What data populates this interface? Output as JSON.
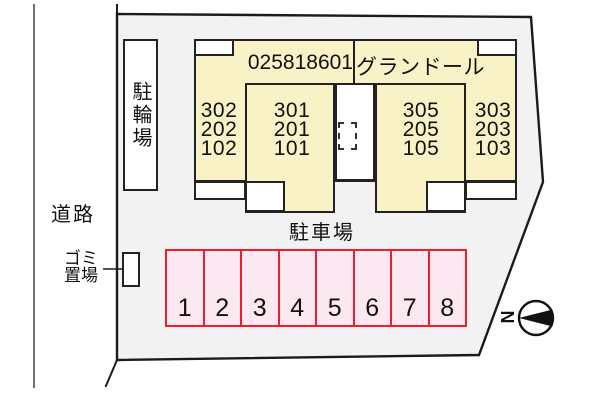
{
  "site": {
    "road_label": "道路",
    "bike_parking_label": "駐輪場",
    "garbage_label_line1": "ゴミ",
    "garbage_label_line2": "置場",
    "parking_lot_label": "駐車場",
    "north_label": "N"
  },
  "building": {
    "code": "025818601",
    "name": "グランドール",
    "unit_columns": [
      {
        "lines": [
          "302",
          "202",
          "102"
        ]
      },
      {
        "lines": [
          "301",
          "201",
          "101"
        ]
      },
      {
        "lines": [
          "305",
          "205",
          "105"
        ]
      },
      {
        "lines": [
          "303",
          "203",
          "103"
        ]
      }
    ]
  },
  "parking": {
    "stalls": [
      "1",
      "2",
      "3",
      "4",
      "5",
      "6",
      "7",
      "8"
    ]
  },
  "colors": {
    "site_fill": "#f2f2f2",
    "building_fill": "#f8f2c6",
    "stall_fill": "#fce8f0",
    "stall_border": "#ee1c2e",
    "line": "#222222",
    "page_background": "#ffffff"
  }
}
